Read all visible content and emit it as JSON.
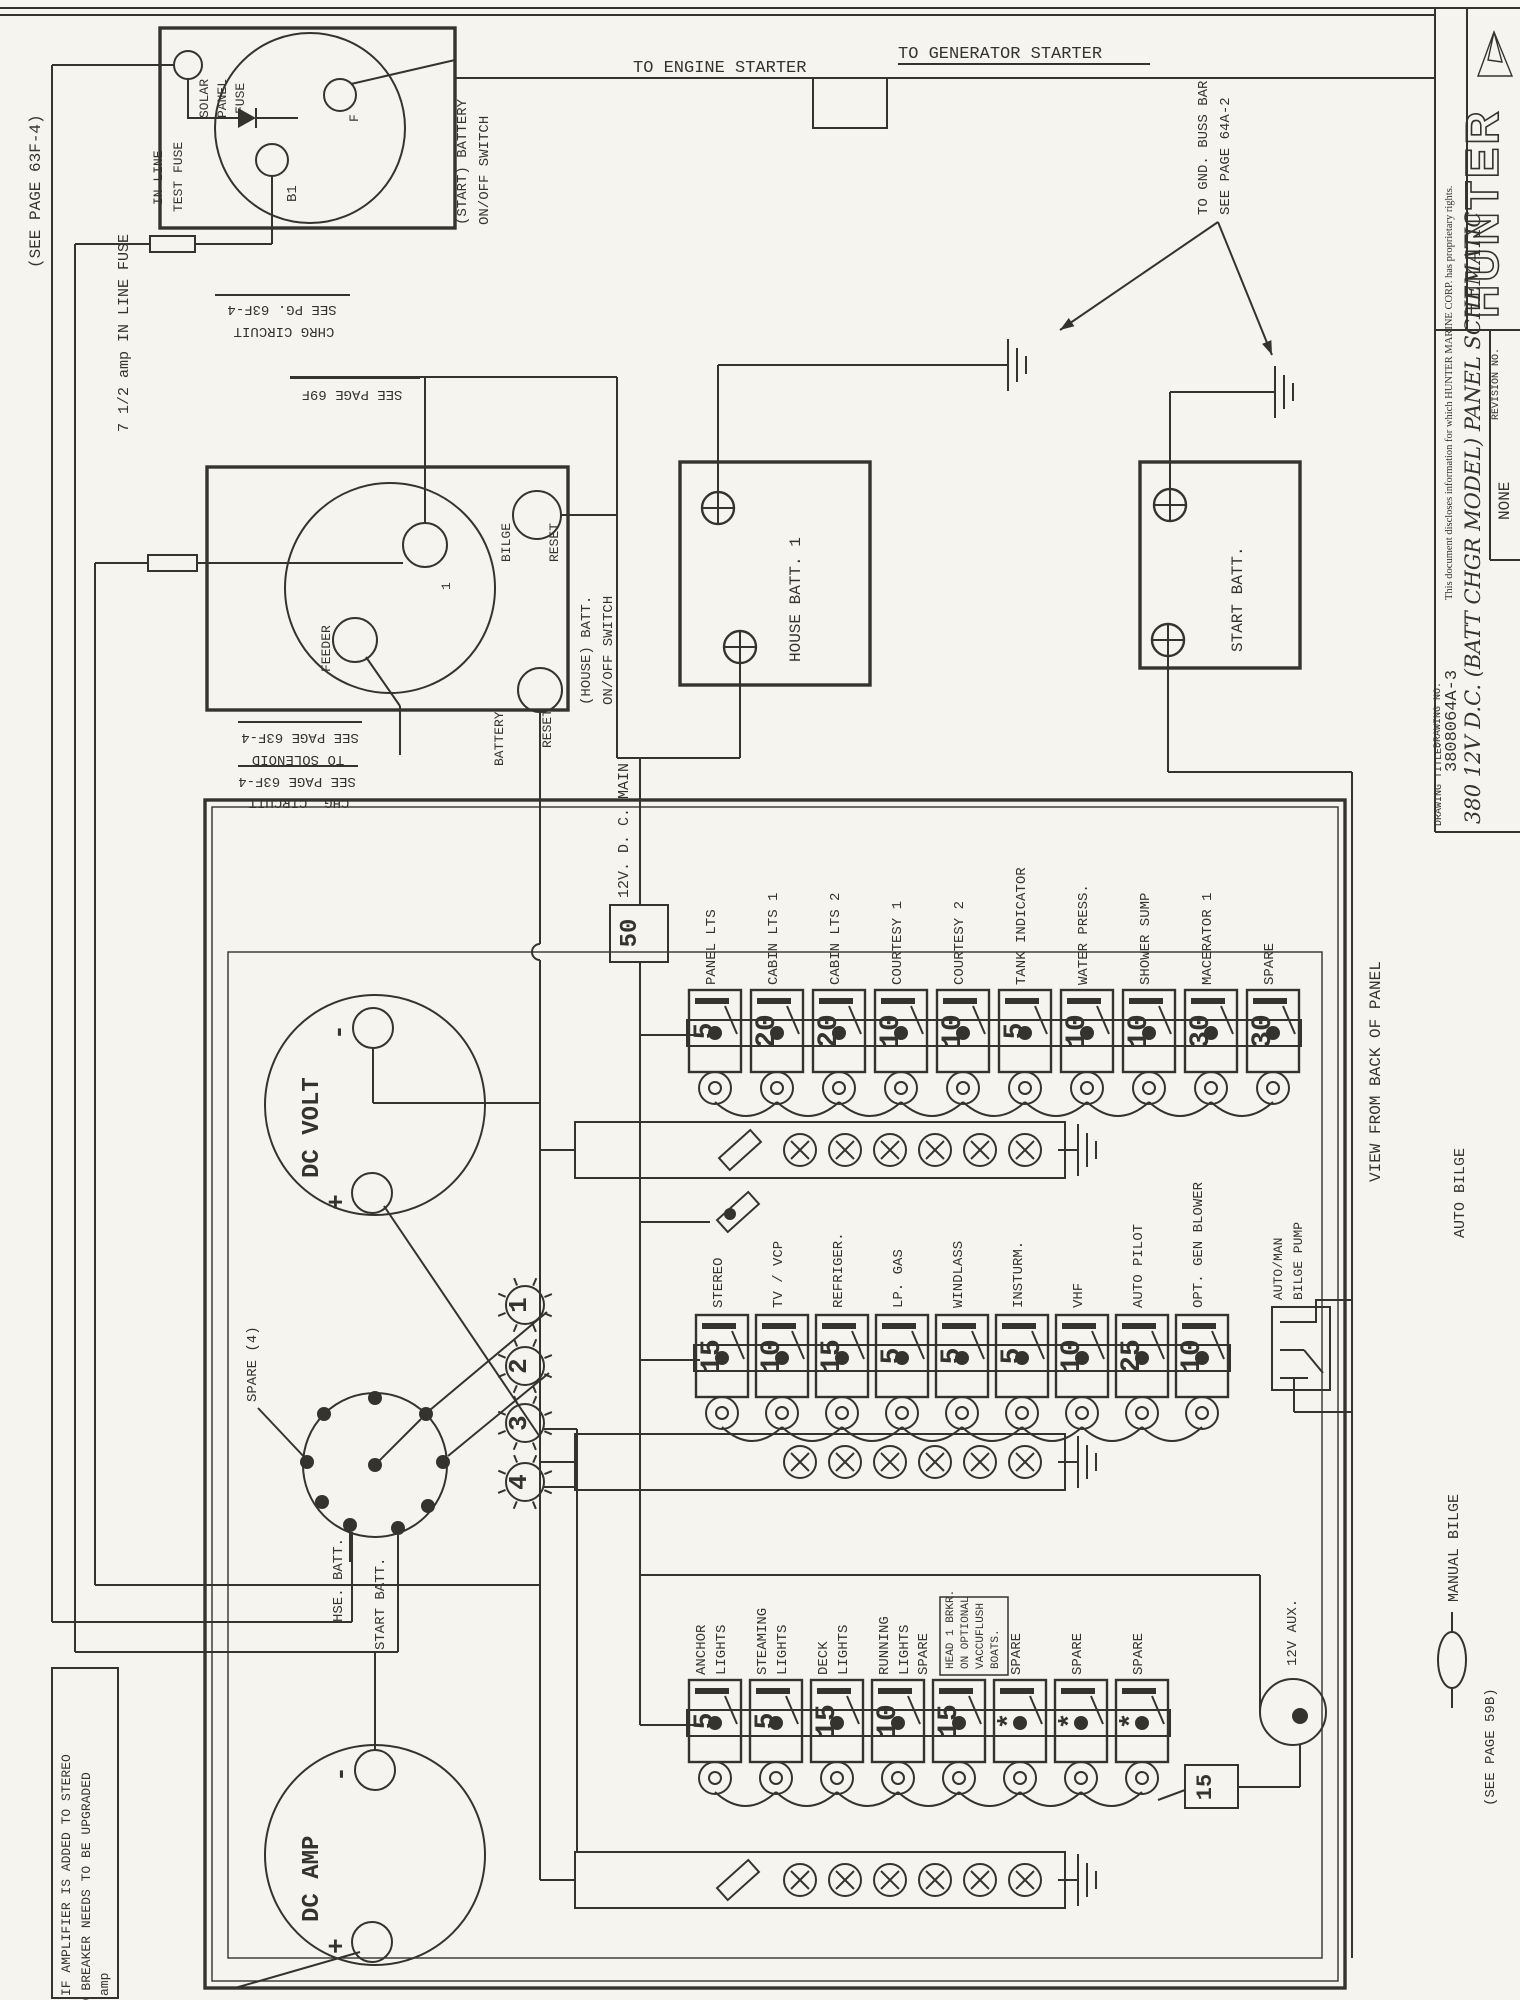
{
  "colors": {
    "ink": "#35332f",
    "paper": "#f6f4ee"
  },
  "header": {
    "see_page_63f4": "(SEE PAGE 63F-4)",
    "to_engine_starter": "TO ENGINE STARTER",
    "to_generator_starter": "TO GENERATOR STARTER",
    "to_gnd_line1": "TO GND. BUSS BAR",
    "to_gnd_line2": "SEE PAGE 64A-2"
  },
  "start_battery_switch": {
    "solar_fuse": [
      "SOLAR",
      "PANEL",
      "FUSE"
    ],
    "inline_fuse": [
      "IN LINE",
      "TEST FUSE"
    ],
    "terminal_f": "F",
    "terminal_b1": "B1",
    "switch_label": [
      "(START) BATTERY",
      "ON/OFF SWITCH"
    ],
    "chrg_note": [
      "CHRG CIRCUIT",
      "SEE PG. 63F-4"
    ]
  },
  "house_battery_switch": {
    "inline_fuse": "7 1/2 amp IN LINE FUSE",
    "feeder": "FEEDER",
    "terminal_1": "1",
    "bilge_reset": [
      "BILGE",
      "RESET"
    ],
    "battery_reset": [
      "BATTERY",
      "RESET"
    ],
    "switch_label": [
      "(HOUSE) BATT.",
      "ON/OFF SWITCH"
    ],
    "see_page_69f": "SEE PAGE 69F",
    "solenoid_note": [
      "SEE PAGE 63F-4",
      "TO SOLENOID"
    ],
    "chg_note": [
      "SEE PAGE 63F-4",
      "CHG. CIRCUIT"
    ]
  },
  "batteries": {
    "house": "HOUSE BATT. 1",
    "start": "START BATT."
  },
  "panel": {
    "main_label": "12V. D. C. MAIN",
    "main_fuse": "50",
    "view_label": "VIEW FROM BACK OF PANEL",
    "banks": [
      {
        "breakers": [
          {
            "label": [
              "PANEL LTS"
            ],
            "value": "5"
          },
          {
            "label": [
              "CABIN LTS 1"
            ],
            "value": "20"
          },
          {
            "label": [
              "CABIN LTS 2"
            ],
            "value": "20"
          },
          {
            "label": [
              "COURTESY 1"
            ],
            "value": "10"
          },
          {
            "label": [
              "COURTESY 2"
            ],
            "value": "10"
          },
          {
            "label": [
              "TANK INDICATOR"
            ],
            "value": "5"
          },
          {
            "label": [
              "WATER PRESS."
            ],
            "value": "10"
          },
          {
            "label": [
              "SHOWER SUMP"
            ],
            "value": "10"
          },
          {
            "label": [
              "MACERATOR 1"
            ],
            "value": "30"
          },
          {
            "label": [
              "SPARE"
            ],
            "value": "30"
          }
        ]
      },
      {
        "breakers": [
          {
            "label": [
              "STEREO"
            ],
            "value": "15"
          },
          {
            "label": [
              "TV / VCP"
            ],
            "value": "10"
          },
          {
            "label": [
              "REFRIGER."
            ],
            "value": "15"
          },
          {
            "label": [
              "LP. GAS"
            ],
            "value": "5"
          },
          {
            "label": [
              "WINDLASS"
            ],
            "value": "5"
          },
          {
            "label": [
              "INSTURM."
            ],
            "value": "5"
          },
          {
            "label": [
              "VHF"
            ],
            "value": "10"
          },
          {
            "label": [
              "AUTO PILOT"
            ],
            "value": "25"
          },
          {
            "label": [
              "OPT. GEN BLOWER"
            ],
            "value": "10"
          }
        ]
      },
      {
        "breakers": [
          {
            "label": [
              "ANCHOR",
              "LIGHTS"
            ],
            "value": "5"
          },
          {
            "label": [
              "STEAMING",
              "LIGHTS"
            ],
            "value": "5"
          },
          {
            "label": [
              "DECK",
              "LIGHTS"
            ],
            "value": "15"
          },
          {
            "label": [
              "RUNNING",
              "LIGHTS"
            ],
            "value": "10"
          },
          {
            "label": [
              "SPARE"
            ],
            "value": "15",
            "note": [
              "HEAD 1 BRKR.",
              "ON OPTIONAL",
              "VACCUFLUSH",
              "BOATS."
            ]
          },
          {
            "label": [
              "SPARE"
            ],
            "value": "*"
          },
          {
            "label": [
              "SPARE"
            ],
            "value": "*"
          },
          {
            "label": [
              "SPARE"
            ],
            "value": "*"
          }
        ]
      }
    ],
    "aux_fuse": "15",
    "aux_label": "12V AUX.",
    "lamps": [
      "1",
      "2",
      "3",
      "4"
    ],
    "rotary": {
      "spare": "SPARE (4)",
      "hse": "HSE. BATT.",
      "start": "START BATT."
    },
    "meters": {
      "volt": "DC VOLT",
      "amp": "DC AMP",
      "minus": "-",
      "plus": "+"
    }
  },
  "bilge": {
    "automan": [
      "AUTO/MAN",
      "BILGE PUMP"
    ],
    "auto": "AUTO BILGE",
    "manual": "MANUAL BILGE",
    "see_page": "(SEE PAGE 59B)"
  },
  "note": {
    "lines": [
      "IF AMPLIFIER IS ADDED TO STEREO",
      "30 BREAKER NEEDS TO BE UPGRADED",
      "amp"
    ]
  },
  "title_block": {
    "proprietary": "This document discloses information for which HUNTER MARINE CORP. has proprietary rights.",
    "brand": "HUNTER",
    "drawing_title_label": "DRAWING TITLE:",
    "title": "380 12V D.C. (BATT CHGR MODEL) PANEL SCHEMATIC",
    "drawing_no_label": "DRAWING NO.",
    "drawing_no": "3808064A-3",
    "revision_label": "REVISION NO.",
    "revision": "NONE"
  }
}
